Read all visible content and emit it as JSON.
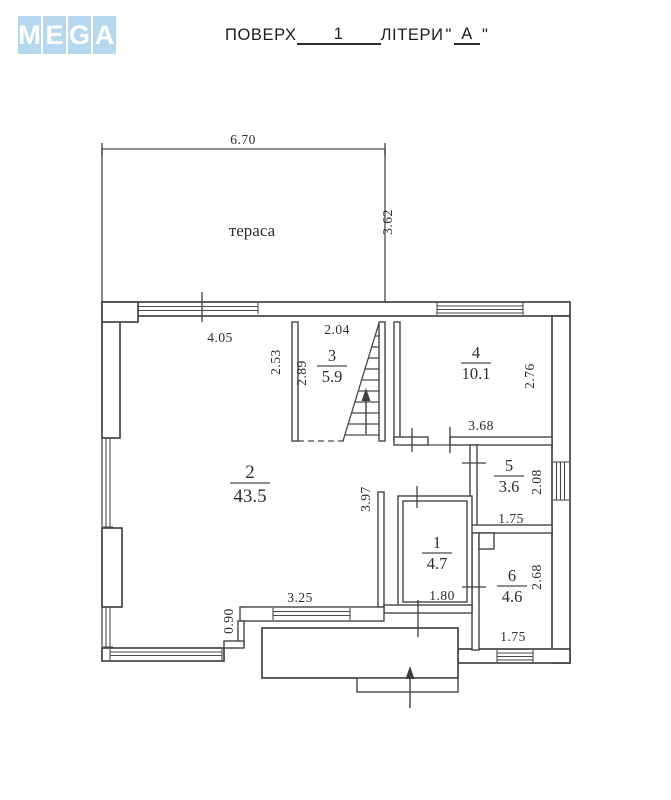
{
  "header": {
    "logo": {
      "letters": [
        "M",
        "E",
        "G",
        "A"
      ],
      "tile_color": "#b5d8ee",
      "letter_color": "#ffffff"
    },
    "title": {
      "prefix": "ПОВЕРХ",
      "floor_value": "1",
      "middle": "ЛІТЕРИ",
      "quote_open": "\"",
      "letter_value": "А",
      "quote_close": "\""
    }
  },
  "plan": {
    "background": "#ffffff",
    "line_color": "#454545",
    "terrace_label": "тераса",
    "rooms": [
      {
        "number": "2",
        "area": "43.5",
        "x": 250,
        "y": 478,
        "big": true
      },
      {
        "number": "3",
        "area": "5.9",
        "x": 332,
        "y": 361,
        "big": false
      },
      {
        "number": "4",
        "area": "10.1",
        "x": 476,
        "y": 358,
        "big": false
      },
      {
        "number": "5",
        "area": "3.6",
        "x": 509,
        "y": 471,
        "big": false
      },
      {
        "number": "6",
        "area": "4.6",
        "x": 512,
        "y": 581,
        "big": false
      },
      {
        "number": "1",
        "area": "4.7",
        "x": 437,
        "y": 548,
        "big": false
      }
    ],
    "dimensions": [
      {
        "text": "6.70",
        "x": 243,
        "y": 144,
        "rotate": false
      },
      {
        "text": "3.62",
        "x": 392,
        "y": 222,
        "rotate": true
      },
      {
        "text": "4.05",
        "x": 220,
        "y": 342,
        "rotate": false
      },
      {
        "text": "2.04",
        "x": 337,
        "y": 334,
        "rotate": false
      },
      {
        "text": "2.53",
        "x": 280,
        "y": 362,
        "rotate": true
      },
      {
        "text": "2.89",
        "x": 306,
        "y": 373,
        "rotate": true
      },
      {
        "text": "2.76",
        "x": 534,
        "y": 376,
        "rotate": true
      },
      {
        "text": "3.68",
        "x": 481,
        "y": 430,
        "rotate": false
      },
      {
        "text": "2.08",
        "x": 541,
        "y": 482,
        "rotate": true
      },
      {
        "text": "1.75",
        "x": 511,
        "y": 523,
        "rotate": false
      },
      {
        "text": "3.97",
        "x": 370,
        "y": 499,
        "rotate": true
      },
      {
        "text": "2.68",
        "x": 541,
        "y": 577,
        "rotate": true
      },
      {
        "text": "1.80",
        "x": 442,
        "y": 600,
        "rotate": false
      },
      {
        "text": "1.75",
        "x": 513,
        "y": 641,
        "rotate": false
      },
      {
        "text": "3.25",
        "x": 300,
        "y": 602,
        "rotate": false
      },
      {
        "text": "0.90",
        "x": 233,
        "y": 621,
        "rotate": true
      }
    ]
  }
}
